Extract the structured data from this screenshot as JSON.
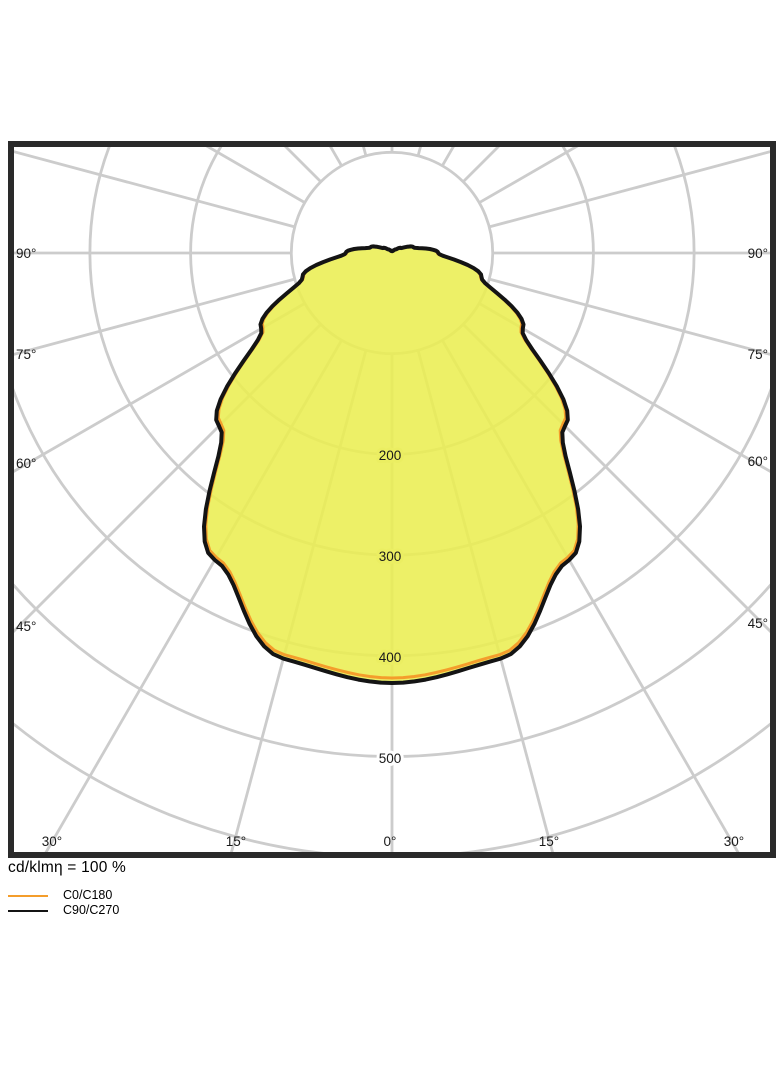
{
  "caption": {
    "text": "cd/klmη = 100 %"
  },
  "legend": {
    "items": [
      {
        "label": "C0/C180",
        "color": "#F49D2B"
      },
      {
        "label": "C90/C270",
        "color": "#141414"
      }
    ]
  },
  "colors": {
    "background": "#ffffff",
    "plot_border": "#2a2a2a",
    "grid": "#cccccc",
    "fill_yellow": "#EAEE50",
    "curve_c0": "#F49D2B",
    "curve_c90": "#141414",
    "text": "#1a1a1a"
  },
  "chart_data": {
    "type": "polar",
    "subtype": "luminous-intensity-distribution",
    "units": "cd/klm",
    "efficiency_text": "cd/klmη = 100 %",
    "gamma_axis": {
      "spoke_step_deg": 15,
      "side_labels": [
        "90°",
        "75°",
        "60°",
        "45°"
      ],
      "bottom_labels": [
        "30°",
        "15°",
        "0°",
        "15°",
        "30°"
      ]
    },
    "radial_axis": {
      "ring_step": 100,
      "rings": [
        100,
        200,
        300,
        400,
        500,
        600
      ],
      "tick_labels": [
        "200",
        "300",
        "400",
        "500"
      ]
    },
    "series": [
      {
        "name": "C0/C180",
        "color": "#F49D2B",
        "stroke_width": 3,
        "points": [
          [
            0,
            422
          ],
          [
            15,
            413
          ],
          [
            30,
            349
          ],
          [
            45,
            240
          ],
          [
            60,
            148
          ],
          [
            75,
            91
          ],
          [
            90,
            45
          ],
          [
            105,
            22
          ],
          [
            120,
            10
          ],
          [
            135,
            5
          ],
          [
            150,
            3
          ],
          [
            165,
            2
          ],
          [
            180,
            2
          ]
        ]
      },
      {
        "name": "C90/C270",
        "color": "#141414",
        "stroke_width": 4,
        "points": [
          [
            0,
            427
          ],
          [
            15,
            417
          ],
          [
            30,
            352
          ],
          [
            45,
            243
          ],
          [
            60,
            150
          ],
          [
            75,
            92
          ],
          [
            90,
            46
          ],
          [
            105,
            22
          ],
          [
            120,
            10
          ],
          [
            135,
            5
          ],
          [
            150,
            3
          ],
          [
            165,
            2
          ],
          [
            180,
            2
          ]
        ]
      }
    ],
    "fill": {
      "series": "C90/C270",
      "color": "#EAEE50",
      "opacity": 0.87
    },
    "layout": {
      "origin_x": 392,
      "origin_y": 253,
      "px_per_unit": 1.007,
      "plot_rect": {
        "x": 11,
        "y": 144,
        "w": 762,
        "h": 711
      },
      "border_width": 6,
      "grid_width": 2.8
    },
    "labels": {
      "left": [
        {
          "text": "90°",
          "x": 16,
          "y": 258
        },
        {
          "text": "75°",
          "x": 16,
          "y": 359
        },
        {
          "text": "60°",
          "x": 16,
          "y": 468
        },
        {
          "text": "45°",
          "x": 16,
          "y": 631
        }
      ],
      "right": [
        {
          "text": "90°",
          "x": 768,
          "y": 258
        },
        {
          "text": "75°",
          "x": 768,
          "y": 359
        },
        {
          "text": "60°",
          "x": 768,
          "y": 466
        },
        {
          "text": "45°",
          "x": 768,
          "y": 628
        }
      ],
      "bottom": [
        {
          "text": "30°",
          "x": 52,
          "y": 846
        },
        {
          "text": "15°",
          "x": 236,
          "y": 846
        },
        {
          "text": "0°",
          "x": 390,
          "y": 846
        },
        {
          "text": "15°",
          "x": 549,
          "y": 846
        },
        {
          "text": "30°",
          "x": 734,
          "y": 846
        }
      ],
      "radial": [
        {
          "text": "200",
          "x": 390,
          "y": 460,
          "halo": "#ebee62"
        },
        {
          "text": "300",
          "x": 390,
          "y": 561,
          "halo": "#ebee62"
        },
        {
          "text": "400",
          "x": 390,
          "y": 662,
          "halo": "#ebee62"
        },
        {
          "text": "500",
          "x": 390,
          "y": 763,
          "halo": "#ffffff"
        }
      ]
    }
  }
}
